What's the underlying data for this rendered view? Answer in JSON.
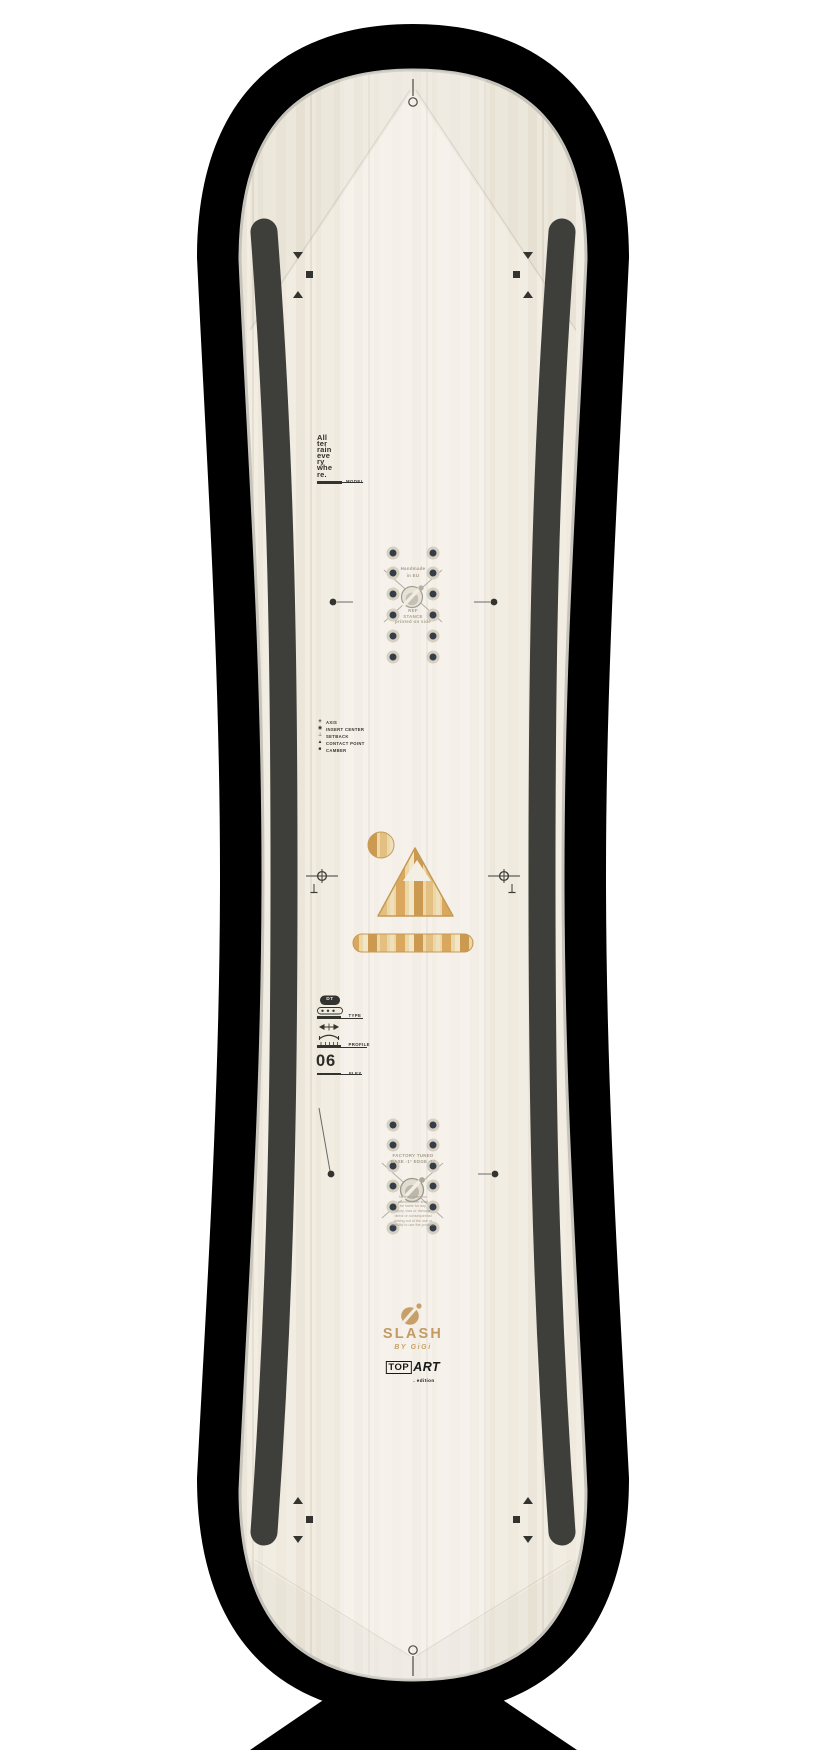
{
  "product_view": "snowboard-top-sheet",
  "branding": {
    "logo_icon": "slash-circle-icon",
    "name": "SLASH",
    "byline": "BY GiGi",
    "badge": {
      "top": "TOP",
      "art": "ART",
      "suffix": ". edition"
    }
  },
  "model": {
    "stacked_text": "All\nter\nrain\neve\nry\nwhe\nre.",
    "label": "MODEL"
  },
  "center_markings_front": {
    "handmade": "Handmade\nin EU",
    "ref_stance": "REF\nSTANCE\nprinted on side"
  },
  "center_markings_back": {
    "factory_tuned": "FACTORY TUNED\nBASE -1°  EDGE -1°",
    "disclaimer": "Neither seller nor\nmanufacturer shall\nbe liable for any\ninjury, loss or damage\ndirect or consequential\narising out of the use or\ninability to use the product."
  },
  "legend": {
    "items": [
      {
        "icon": "axis-icon",
        "label": "AXIS"
      },
      {
        "icon": "insert-center-icon",
        "label": "INSERT CENTER"
      },
      {
        "icon": "setback-icon",
        "label": "SETBACK"
      },
      {
        "icon": "contact-point-icon",
        "label": "CONTACT POINT"
      },
      {
        "icon": "camber-icon",
        "label": "CAMBER"
      }
    ]
  },
  "specs": {
    "type": {
      "label": "TYPE",
      "value": "DT"
    },
    "profile": {
      "label": "PROFILE"
    },
    "flex": {
      "label": "FLEX",
      "value": "06"
    }
  },
  "colors": {
    "background": "#ffffff",
    "silhouette": "#000000",
    "topsheet": "#f2ede3",
    "rail": "#3e3f3a",
    "ink": "#33342f",
    "muted_text": "#a49c8b",
    "gold": "#c39b62",
    "wood_tan": "#d9a75e",
    "insert_hole": "#343e48"
  }
}
